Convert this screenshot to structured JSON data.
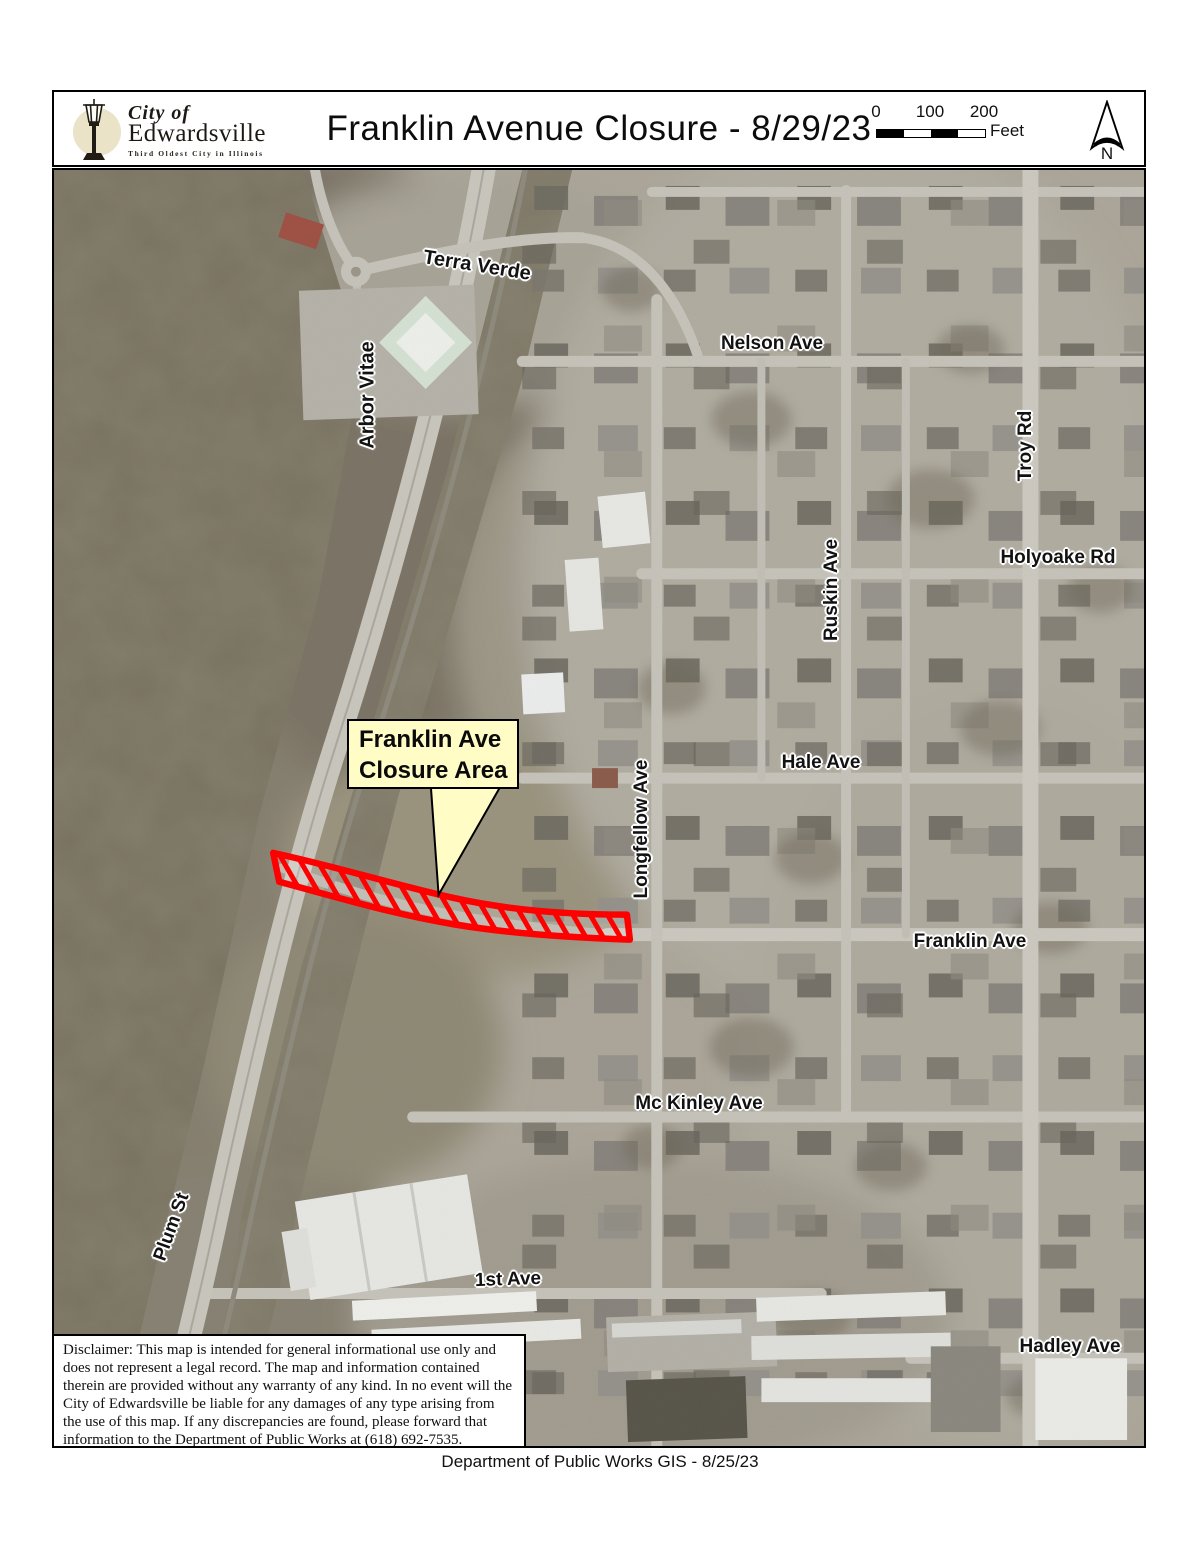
{
  "theme": {
    "closure_red": "#ff0000",
    "callout_yellow": "#fffcc6",
    "label_halo": "#ffffff"
  },
  "header": {
    "logo": {
      "script_line": "City of",
      "name_line": "Edwardsville",
      "tagline": "Third Oldest City in Illinois"
    },
    "title": "Franklin Avenue Closure - 8/29/23",
    "scale_bar": {
      "tick_labels": [
        "0",
        "100",
        "200"
      ],
      "unit_label": "Feet"
    },
    "north_arrow_label": "N"
  },
  "map": {
    "callout": {
      "line1": "Franklin Ave",
      "line2": "Closure Area"
    },
    "street_labels": [
      {
        "id": "terra-verde",
        "text": "Terra Verde",
        "x": 423,
        "y": 96,
        "rot": 9,
        "size": 20
      },
      {
        "id": "arbor-vitae",
        "text": "Arbor Vitae",
        "x": 314,
        "y": 225,
        "rot": -90,
        "size": 20
      },
      {
        "id": "nelson-ave",
        "text": "Nelson Ave",
        "x": 718,
        "y": 174,
        "rot": 0,
        "size": 19
      },
      {
        "id": "troy-rd",
        "text": "Troy Rd",
        "x": 972,
        "y": 276,
        "rot": -90,
        "size": 19
      },
      {
        "id": "holyoake-rd",
        "text": "Holyoake Rd",
        "x": 1004,
        "y": 388,
        "rot": 0,
        "size": 19
      },
      {
        "id": "ruskin-ave",
        "text": "Ruskin Ave",
        "x": 778,
        "y": 420,
        "rot": -90,
        "size": 19
      },
      {
        "id": "hale-ave",
        "text": "Hale Ave",
        "x": 767,
        "y": 593,
        "rot": 0,
        "size": 19
      },
      {
        "id": "longfellow-ave",
        "text": "Longfellow Ave",
        "x": 588,
        "y": 659,
        "rot": -90,
        "size": 19
      },
      {
        "id": "franklin-ave",
        "text": "Franklin Ave",
        "x": 916,
        "y": 772,
        "rot": 0,
        "size": 19
      },
      {
        "id": "mc-kinley-ave",
        "text": "Mc Kinley Ave",
        "x": 645,
        "y": 934,
        "rot": 0,
        "size": 19
      },
      {
        "id": "plum-st",
        "text": "Plum St",
        "x": 118,
        "y": 1057,
        "rot": -70,
        "size": 19
      },
      {
        "id": "first-ave",
        "text": "1st Ave",
        "x": 454,
        "y": 1110,
        "rot": -2,
        "size": 19
      },
      {
        "id": "hadley-ave",
        "text": "Hadley Ave",
        "x": 1016,
        "y": 1177,
        "rot": 0,
        "size": 19
      }
    ]
  },
  "disclaimer": {
    "text": "Disclaimer: This map is intended for general informational use only and does not represent a legal record. The map and information contained therein are provided without any warranty of any kind. In no event will the City of Edwardsville be liable for any damages of any type arising from the use of this map. If any discrepancies are found, please forward that information to the Department of Public Works at (618) 692-7535."
  },
  "footer": {
    "text": "Department of Public Works GIS - 8/25/23"
  }
}
